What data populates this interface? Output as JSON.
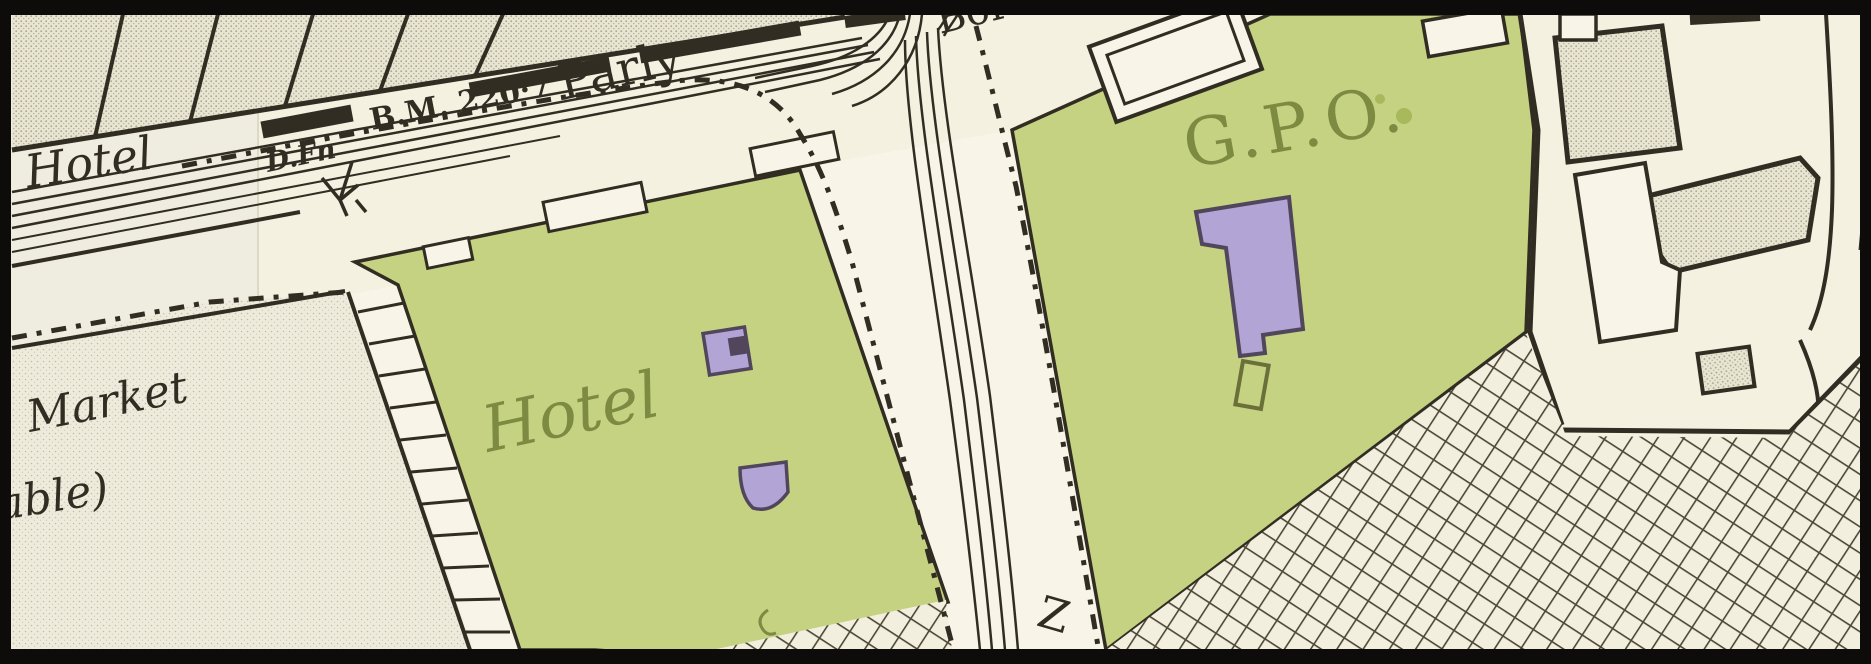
{
  "map": {
    "labels": {
      "hotel_row": "Hotel",
      "benchmark": "B.M. 220·7",
      "drinking_fountain": "D.Fn",
      "parliamentary_boundary": "Parly",
      "boundary_continuation": "Boro",
      "hotel_block": "Hotel",
      "general_post_office": "G.P.O.",
      "market": "Market",
      "market_continuation": "able)",
      "street_letter": "Z"
    },
    "colors": {
      "paper": "#f4f1e1",
      "paper_left_tile": "#efece0",
      "road": "#f8f5e8",
      "block_green": "#c5d282",
      "tree_green": "#a8b95c",
      "building_purple": "#b2a4d5",
      "purple_outline": "#51465c",
      "label_olive": "#7d8a41",
      "ink": "#322d22",
      "border_black": "#0d0c0a"
    }
  }
}
